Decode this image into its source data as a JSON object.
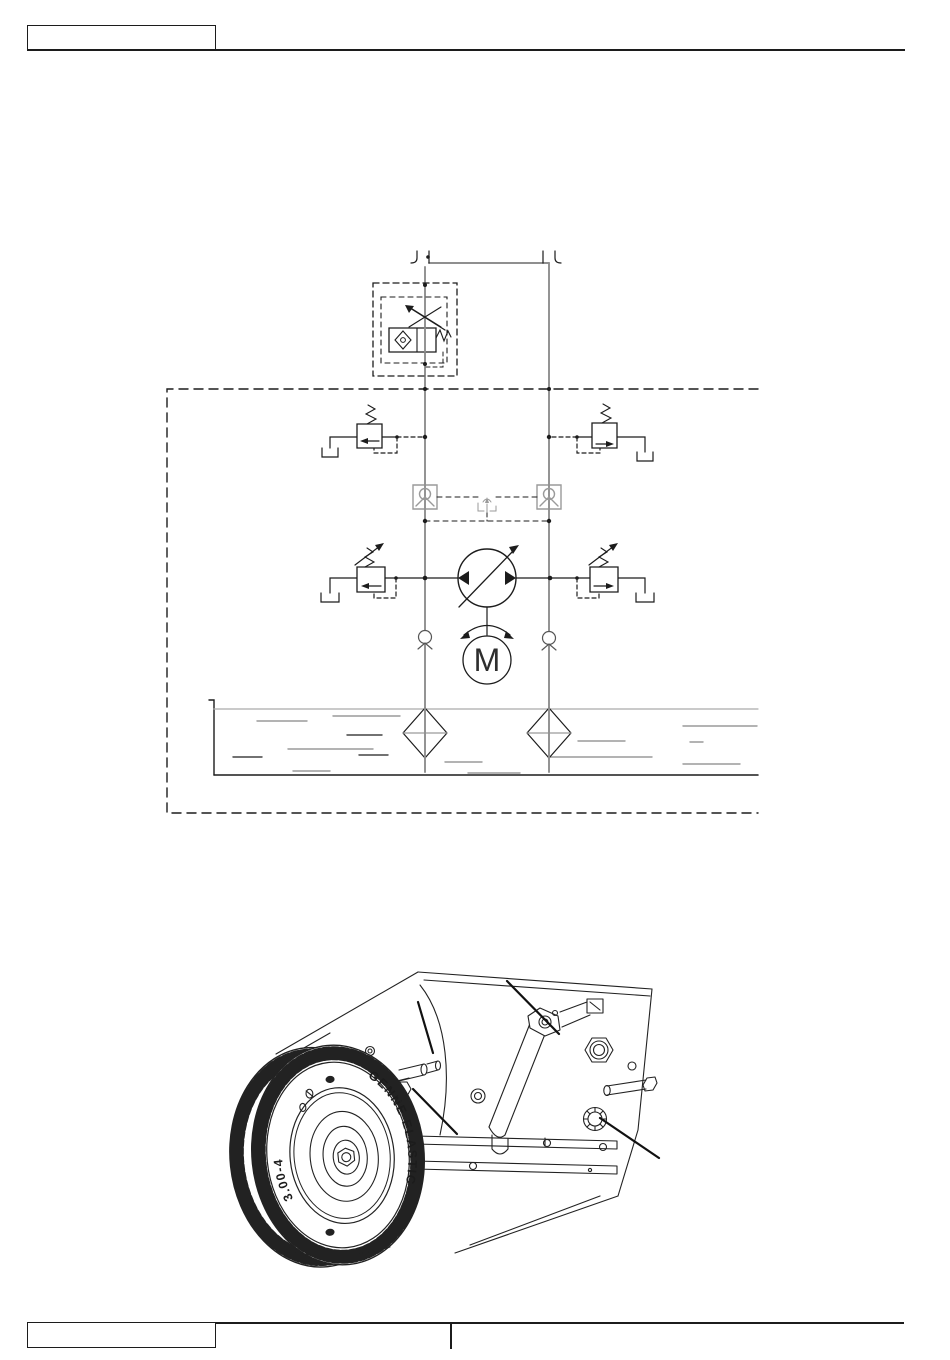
{
  "page": {
    "bg_color": "#ffffff",
    "line_color": "#1c1c1c",
    "pipe_color": "#8f8f8f",
    "dash_color": "#222222"
  },
  "header": {
    "model_box_text": ""
  },
  "footer": {
    "left_box_text": "",
    "center_cell_text": ""
  },
  "schematic": {
    "kind": "hydraulic-drive-circuit-diagram",
    "motor_letter": "M",
    "components": [
      "line-coupling-left",
      "line-coupling-right",
      "towing-bypass-valve",
      "left-shock-relief-valve",
      "right-shock-relief-valve",
      "left-pilot-check-valve",
      "right-pilot-check-valve",
      "shuttle-valve",
      "variable-displacement-pump",
      "drive-motor",
      "left-pressure-relief-valve",
      "right-pressure-relief-valve",
      "left-makeup-check-valve",
      "right-makeup-check-valve",
      "oil-reservoir",
      "left-suction-strainer",
      "right-suction-strainer",
      "transmission-boundary"
    ]
  },
  "illustration": {
    "kind": "rear-drive-wheel-assembly-drawing",
    "tire_brand_text": "GENNE ELASTIC",
    "tire_size_text": "3.00-4",
    "leader_count": 4
  }
}
